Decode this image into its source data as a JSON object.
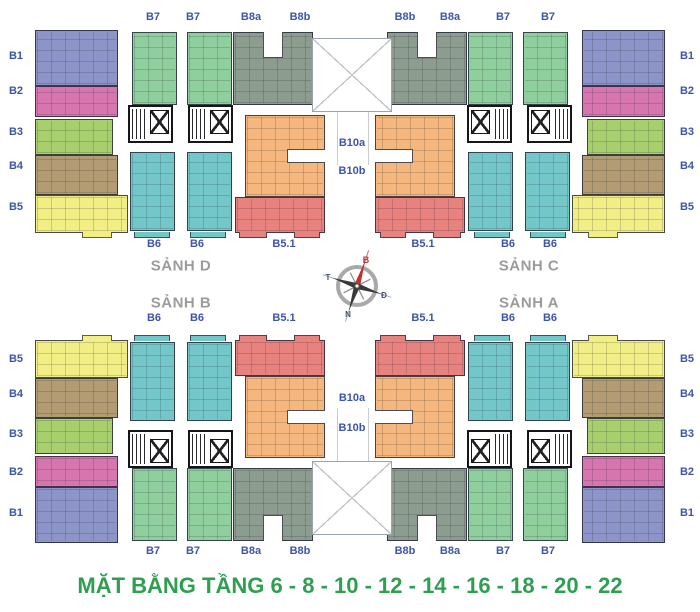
{
  "title": "MẶT BẰNG TẦNG 6 - 8 - 10 - 12 - 14 - 16 - 18 - 20 - 22",
  "lobbies": {
    "sanh_d": "SẢNH D",
    "sanh_c": "SẢNH C",
    "sanh_b": "SẢNH B",
    "sanh_a": "SẢNH A"
  },
  "compass": {
    "north": "B",
    "west": "T",
    "east": "Đ",
    "south": "N"
  },
  "unit_labels": {
    "b1": "B1",
    "b2": "B2",
    "b3": "B3",
    "b4": "B4",
    "b5": "B5",
    "b51": "B5.1",
    "b6": "B6",
    "b7": "B7",
    "b8a": "B8a",
    "b8b": "B8b",
    "b10a": "B10a",
    "b10b": "B10b"
  },
  "palette": {
    "b1": "#8D95C8",
    "b2": "#D776AE",
    "b3": "#A8CF6E",
    "b4": "#B39C74",
    "b5": "#F2EE86",
    "b6": "#73C7C9",
    "b7": "#8FCF9D",
    "b8": "#8C9C8E",
    "b10": "#F5B77E",
    "b51": "#E8827F",
    "label_text": "#3D55A8",
    "lobby_text": "#9B9B9B",
    "title_text": "#2E9E51",
    "compass_north": "#C03030"
  }
}
